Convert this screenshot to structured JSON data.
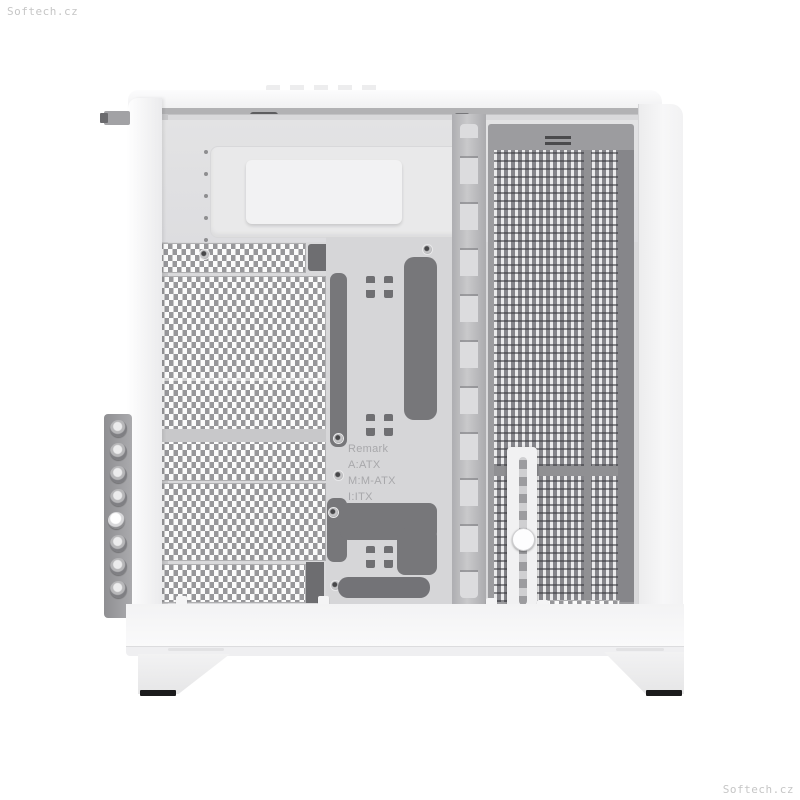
{
  "image": {
    "type": "product-photo",
    "subject": "White dual-chamber PC tower case, side panel removed, interior view"
  },
  "watermarks": {
    "top_left": "Softech.cz",
    "bottom_right": "Softech.cz"
  },
  "tray": {
    "remark_title": "Remark",
    "remark_lines": [
      "A:ATX",
      "M:M-ATX",
      "I:ITX"
    ]
  },
  "colors": {
    "background": "#ffffff",
    "body_white": "#f5f5f6",
    "interior_gray": "#d9d9db",
    "mesh_light": "#fbfbfb",
    "mesh_hole_gray": "#97979a",
    "rear_mesh_gray": "#85858a",
    "cutout_dark": "#77777a",
    "cable_bar_gray": "#bcbcbe",
    "foot_pad_black": "#1b1b1c",
    "watermark_gray": "#c6c6c6"
  }
}
